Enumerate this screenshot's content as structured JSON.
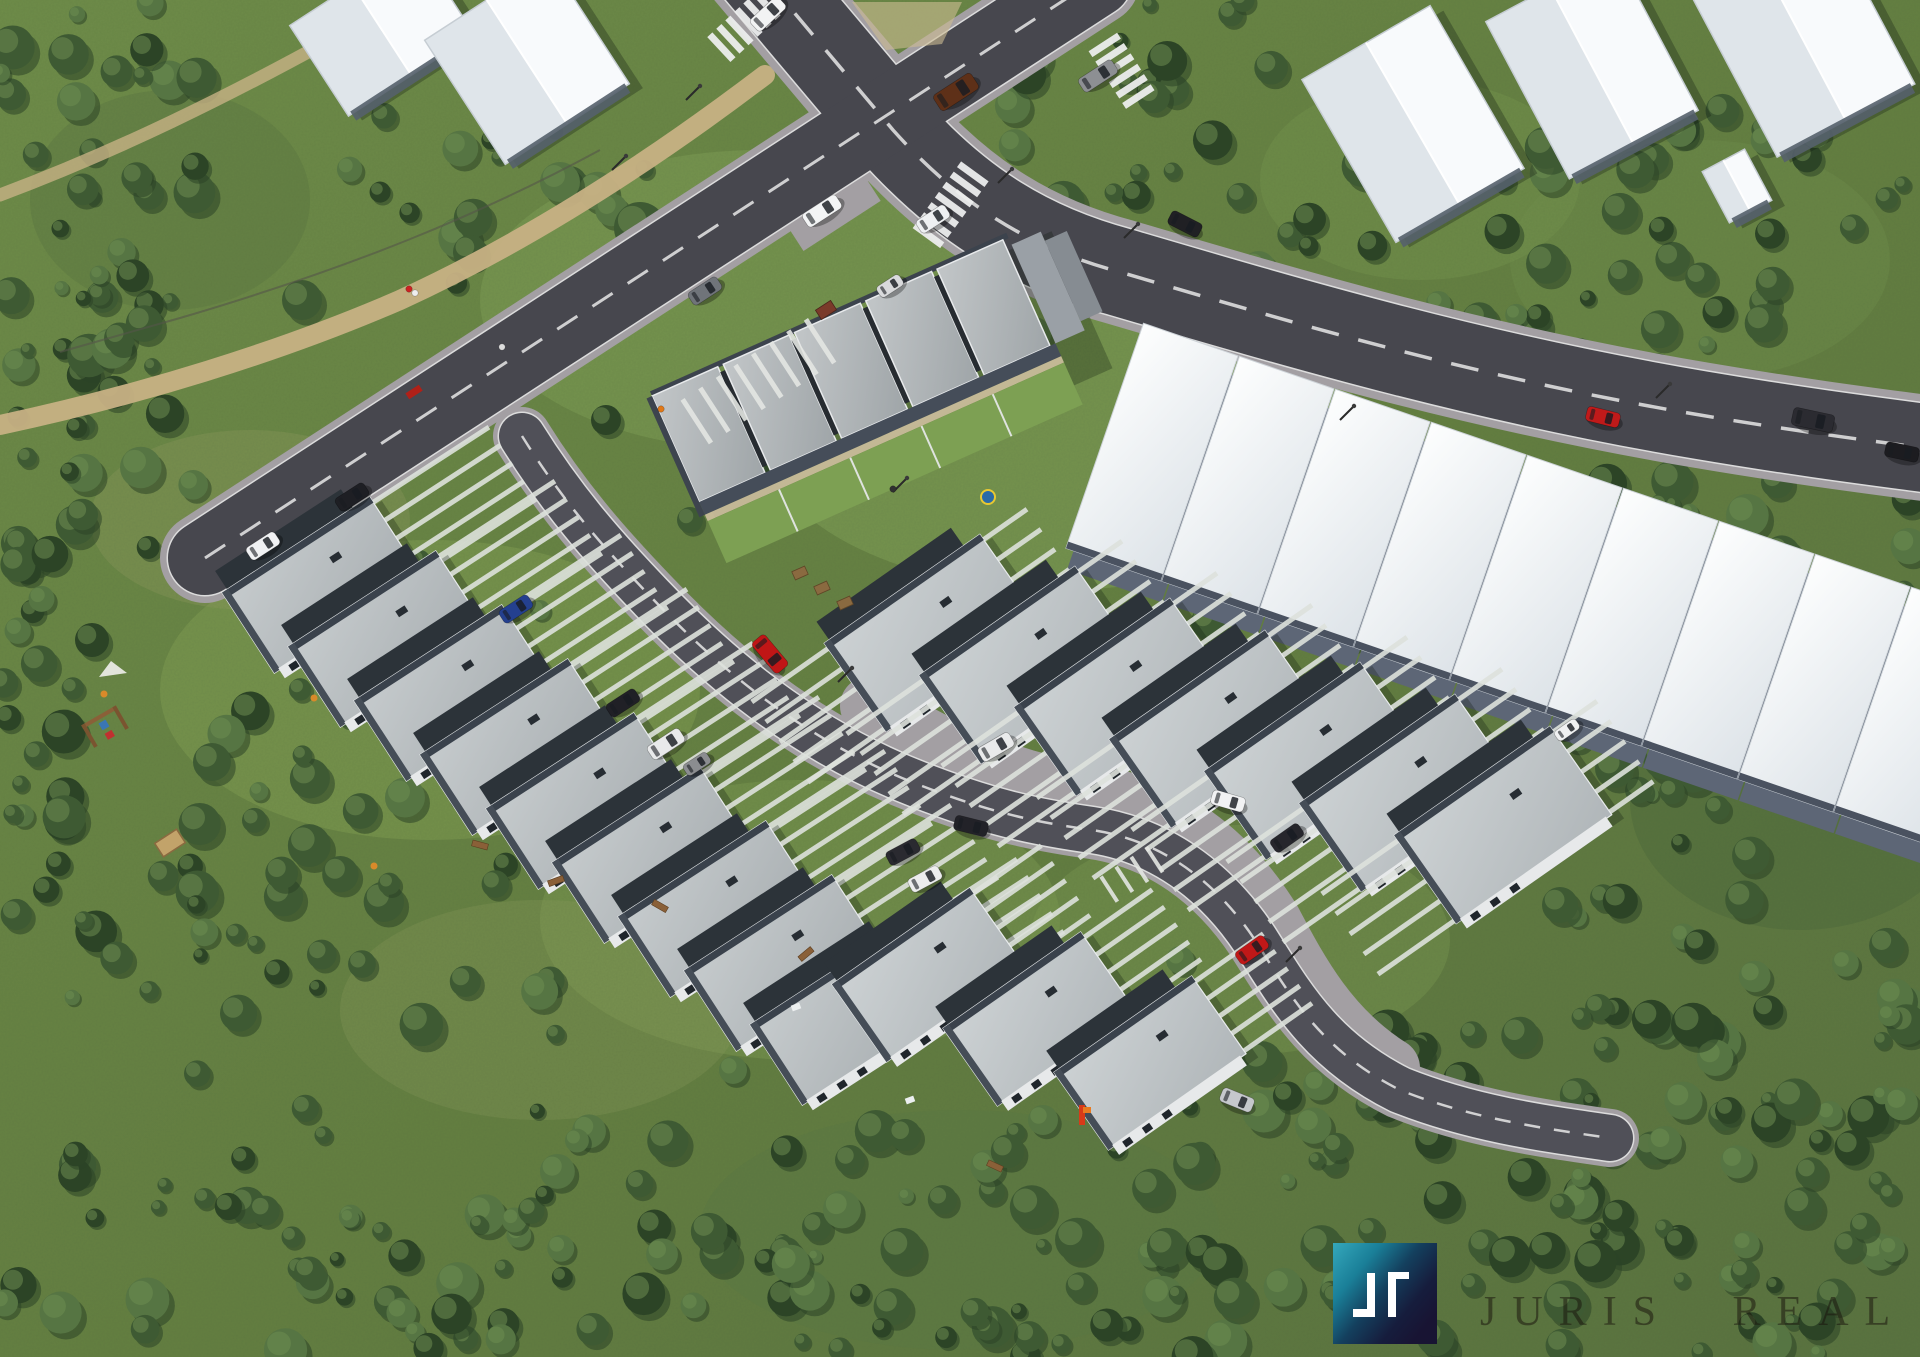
{
  "branding": {
    "watermark_text": "JURIS REAL",
    "logo": {
      "x": 1333,
      "y": 1243,
      "w": 104,
      "h": 101,
      "teal": "#35a8bc",
      "mid": "#1a7f98",
      "deep": "#14405e",
      "navy1": "#161d3d",
      "navy2": "#181433",
      "glyph_color": "#ffffff",
      "glyph_left_path": "M1367 1273 H1375 V1317 H1353 V1309 H1367 Z",
      "glyph_right_path": "M1388 1272 H1409 V1279 H1396 V1317 H1388 Z"
    }
  },
  "palette": {
    "grass1": "#6f8d49",
    "grass2": "#647f41",
    "grass3": "#5a7340",
    "forest_dark": "#2c4426",
    "forest_mid": "#3e5a33",
    "forest_light": "#567543",
    "forest_hi": "#6d8c50",
    "asphalt": "#47474e",
    "asphalt_inner": "#505058",
    "cobble": "#a39fa3",
    "lane": "#e8e8e8",
    "path_tan": "#c7b184",
    "stripe": "#dde1dc",
    "roof_a1": "#c6cbcd",
    "roof_a2": "#a8aeb1",
    "roof_b1": "#cdd2d4",
    "roof_b2": "#b0b6b9",
    "block_roof1": "#c2c6c8",
    "block_roof2": "#9fa5a8",
    "white_roof1": "#fdfefe",
    "white_roof2": "#dde3e8",
    "parapet": "#3a424c",
    "dark_band": "#2c3339",
    "facade": "#e7e9ea",
    "wall_dark": "#55606c"
  },
  "scene": {
    "terrain_patches": [
      {
        "cx": 430,
        "cy": 690,
        "rx": 270,
        "ry": 150,
        "c": "#84a155",
        "o": 0.45
      },
      {
        "cx": 800,
        "cy": 920,
        "rx": 260,
        "ry": 140,
        "c": "#82a055",
        "o": 0.4
      },
      {
        "cx": 1240,
        "cy": 940,
        "rx": 210,
        "ry": 115,
        "c": "#7d9b52",
        "o": 0.4
      },
      {
        "cx": 1060,
        "cy": 430,
        "rx": 300,
        "ry": 160,
        "c": "#83a459",
        "o": 0.5
      },
      {
        "cx": 760,
        "cy": 300,
        "rx": 280,
        "ry": 150,
        "c": "#7fa055",
        "o": 0.5
      },
      {
        "cx": 250,
        "cy": 520,
        "rx": 160,
        "ry": 90,
        "c": "#8f9a5e",
        "o": 0.35
      },
      {
        "cx": 540,
        "cy": 1010,
        "rx": 200,
        "ry": 110,
        "c": "#8c9a5c",
        "o": 0.3
      },
      {
        "cx": 1700,
        "cy": 260,
        "rx": 190,
        "ry": 120,
        "c": "#6e8c4a",
        "o": 0.5
      },
      {
        "cx": 1420,
        "cy": 180,
        "rx": 160,
        "ry": 100,
        "c": "#75944e",
        "o": 0.45
      },
      {
        "cx": 170,
        "cy": 200,
        "rx": 140,
        "ry": 110,
        "c": "#5d7a42",
        "o": 0.5
      },
      {
        "cx": 1800,
        "cy": 800,
        "rx": 170,
        "ry": 130,
        "c": "#4e6a3c",
        "o": 0.5
      },
      {
        "cx": 960,
        "cy": 1230,
        "rx": 260,
        "ry": 120,
        "c": "#5c7a44",
        "o": 0.5
      }
    ],
    "forests": [
      {
        "x": 0,
        "y": 0,
        "w": 200,
        "h": 560,
        "n": 55,
        "seed": 11
      },
      {
        "x": 0,
        "y": 540,
        "w": 120,
        "h": 240,
        "n": 16,
        "seed": 12
      },
      {
        "x": 0,
        "y": 780,
        "w": 560,
        "h": 577,
        "n": 95,
        "seed": 13
      },
      {
        "x": 530,
        "y": 1130,
        "w": 640,
        "h": 227,
        "n": 55,
        "seed": 14
      },
      {
        "x": 1150,
        "y": 1030,
        "w": 770,
        "h": 327,
        "n": 115,
        "seed": 15
      },
      {
        "x": 1545,
        "y": 470,
        "w": 375,
        "h": 580,
        "n": 85,
        "seed": 16
      },
      {
        "x": 1570,
        "y": 90,
        "w": 350,
        "h": 350,
        "n": 38,
        "seed": 17
      },
      {
        "x": 1245,
        "y": 125,
        "w": 320,
        "h": 200,
        "n": 24,
        "seed": 18
      },
      {
        "x": 985,
        "y": 0,
        "w": 290,
        "h": 210,
        "n": 26,
        "seed": 19
      },
      {
        "x": 315,
        "y": 115,
        "w": 340,
        "h": 175,
        "n": 16,
        "seed": 20
      },
      {
        "x": 205,
        "y": 600,
        "w": 220,
        "h": 200,
        "n": 8,
        "seed": 21
      }
    ],
    "trees": [
      [
        640,
        228,
        26
      ],
      [
        560,
        182,
        20
      ],
      [
        470,
        252,
        17
      ],
      [
        302,
        300,
        20
      ],
      [
        880,
        318,
        15
      ],
      [
        1034,
        334,
        17
      ],
      [
        1140,
        420,
        19
      ],
      [
        1258,
        518,
        21
      ],
      [
        1208,
        622,
        17
      ],
      [
        1416,
        624,
        15
      ],
      [
        690,
        520,
        13
      ],
      [
        606,
        420,
        15
      ],
      [
        762,
        472,
        11
      ],
      [
        1320,
        758,
        15
      ],
      [
        1462,
        800,
        13
      ],
      [
        92,
        640,
        17
      ],
      [
        212,
        762,
        19
      ],
      [
        540,
        610,
        10
      ],
      [
        420,
        560,
        10
      ],
      [
        330,
        480,
        11
      ],
      [
        1560,
        905,
        18
      ],
      [
        1180,
        960,
        14
      ],
      [
        905,
        1135,
        16
      ],
      [
        1043,
        1120,
        15
      ],
      [
        733,
        1070,
        14
      ],
      [
        850,
        1160,
        15
      ],
      [
        1350,
        640,
        12
      ],
      [
        1240,
        690,
        11
      ]
    ],
    "paths": [
      {
        "name": "footpath-main",
        "d": "M765,75 C640,170 520,245 400,300 C280,352 140,395 0,425",
        "w": 20,
        "o": 0.95
      },
      {
        "name": "footpath-corner",
        "d": "M330,40 C230,95 120,150 0,195",
        "w": 13,
        "o": 0.8
      }
    ],
    "fence": {
      "d": "M600,150 C480,215 350,268 180,318 L60,352"
    },
    "roads": [
      {
        "name": "main-road",
        "d": "M733,-60 L893,130 C960,205 1030,248 1120,272 C1300,325 1480,378 1700,415 C1800,432 1880,442 1940,450",
        "w": 88,
        "cas": 106,
        "dash": "28 20",
        "dw": 3.5
      },
      {
        "name": "cross-road",
        "d": "M205,558 L1095,-20",
        "w": 74,
        "cas": 90,
        "dash": "24 18",
        "dw": 3
      },
      {
        "name": "inner-road",
        "d": "M522,436 C562,500 602,546 650,596 C722,672 802,736 902,778 C985,812 1035,822 1092,830 C1160,840 1215,880 1255,940 C1290,995 1320,1050 1400,1090 C1470,1118 1540,1128 1610,1138",
        "w": 46,
        "cas": 58,
        "dash": "16 14",
        "dw": 2.5
      }
    ],
    "cobble_band": {
      "d": "M870,706 C950,756 1015,782 1090,794 C1180,808 1235,862 1272,922 C1300,975 1330,1030 1390,1068",
      "w": 60
    },
    "island": {
      "pts": "852,2 962,2 942,44 886,50",
      "c": "#cdbd93",
      "o": 0.6
    },
    "crosswalks": [
      {
        "x": 742,
        "y": 28,
        "rot": 47,
        "n": 6,
        "span": 74
      },
      {
        "x": 1123,
        "y": 73,
        "rot": -33,
        "n": 6,
        "span": 74
      },
      {
        "x": 949,
        "y": 207,
        "rot": 36,
        "n": 7,
        "span": 88
      }
    ],
    "laybys": [
      {
        "x": 835,
        "y": 215,
        "rot": -33,
        "w": 92,
        "h": 26
      },
      {
        "x": 243,
        "y": 547,
        "rot": -33,
        "w": 72,
        "h": 24
      }
    ],
    "neighbors": [
      {
        "x": 382,
        "y": 30,
        "rot": -33,
        "w": 150,
        "h": 108
      },
      {
        "x": 527,
        "y": 62,
        "rot": -33,
        "w": 148,
        "h": 148
      },
      {
        "x": 1413,
        "y": 124,
        "rot": -30,
        "w": 148,
        "h": 188
      },
      {
        "x": 1592,
        "y": 66,
        "rot": -28,
        "w": 146,
        "h": 178
      },
      {
        "x": 1800,
        "y": 34,
        "rot": -28,
        "w": 156,
        "h": 196
      },
      {
        "x": 1737,
        "y": 186,
        "rot": -28,
        "w": 48,
        "h": 58
      }
    ],
    "central_block": {
      "x": 652,
      "y": 396,
      "rot": -24,
      "units": 5,
      "uw": 78,
      "rw": 72,
      "depth": 116
    },
    "long_white": {
      "x0": 1152,
      "y0": 452,
      "dx": 96,
      "dy": 33,
      "rot": 19,
      "count": 9,
      "w": 100,
      "h": 238
    },
    "house_groups": [
      {
        "name": "west-cascade",
        "count": 9,
        "cx": 322,
        "cy": 585,
        "dx": 66,
        "dy": 54,
        "rot": -33,
        "w": 176,
        "h": 96,
        "roof": "a",
        "sne": 140,
        "ssw": 0
      },
      {
        "name": "east-row",
        "count": 7,
        "cx": 933,
        "cy": 633,
        "dx": 95,
        "dy": 32,
        "rot": -35,
        "w": 190,
        "h": 108,
        "roof": "b",
        "sne": 55,
        "ssw": 95
      },
      {
        "name": "south-row",
        "count": 3,
        "cx": 928,
        "cy": 975,
        "dx": 111,
        "dy": 44,
        "rot": -35,
        "w": 168,
        "h": 95,
        "roof": "b",
        "sne": 85,
        "ssw": 0
      }
    ],
    "stripe_groups": [
      {
        "x": 808,
        "y": 318,
        "rot": 57,
        "count": 8,
        "gap": 21,
        "len": 52,
        "wid": 5
      },
      {
        "x": 1148,
        "y": 846,
        "rot": 57,
        "count": 4,
        "gap": 18,
        "len": 30,
        "wid": 4
      }
    ],
    "cars": [
      {
        "x": 263,
        "y": 546,
        "r": -33,
        "c": "#f0f1f3"
      },
      {
        "x": 352,
        "y": 497,
        "r": -33,
        "c": "#1e1f24"
      },
      {
        "x": 705,
        "y": 291,
        "r": -33,
        "c": "#70747a"
      },
      {
        "x": 822,
        "y": 211,
        "r": -33,
        "c": "#f3f4f5",
        "l": 40,
        "w": 16
      },
      {
        "x": 933,
        "y": 219,
        "r": -33,
        "c": "#eef0f2"
      },
      {
        "x": 890,
        "y": 286,
        "r": -33,
        "c": "#d9dadc",
        "l": 27,
        "w": 13
      },
      {
        "x": 956,
        "y": 92,
        "r": -33,
        "c": "#5e3018",
        "l": 45,
        "w": 19
      },
      {
        "x": 1098,
        "y": 76,
        "r": -33,
        "c": "#8d8f93",
        "l": 40,
        "w": 16
      },
      {
        "x": 768,
        "y": 14,
        "r": -43,
        "c": "#f2f3f4",
        "l": 38,
        "w": 16
      },
      {
        "x": 1185,
        "y": 224,
        "r": 27,
        "c": "#202024"
      },
      {
        "x": 1603,
        "y": 417,
        "r": 14,
        "c": "#c01a1a"
      },
      {
        "x": 1813,
        "y": 420,
        "r": 12,
        "c": "#2b2b31",
        "l": 42,
        "w": 18
      },
      {
        "x": 1902,
        "y": 452,
        "r": 12,
        "c": "#1c1c20"
      },
      {
        "x": 770,
        "y": 654,
        "r": 50,
        "c": "#c01616",
        "l": 40,
        "w": 17
      },
      {
        "x": 971,
        "y": 826,
        "r": 14,
        "c": "#222228"
      },
      {
        "x": 1228,
        "y": 801,
        "r": 16,
        "c": "#f1f2f3"
      },
      {
        "x": 516,
        "y": 609,
        "r": -33,
        "c": "#24408f"
      },
      {
        "x": 623,
        "y": 703,
        "r": -33,
        "c": "#202026"
      },
      {
        "x": 666,
        "y": 744,
        "r": -33,
        "c": "#e8e9ea",
        "l": 38,
        "w": 16
      },
      {
        "x": 903,
        "y": 852,
        "r": -28,
        "c": "#2a2a30"
      },
      {
        "x": 925,
        "y": 879,
        "r": -28,
        "c": "#eceded"
      },
      {
        "x": 996,
        "y": 747,
        "r": -30,
        "c": "#e9eaeb",
        "l": 36,
        "w": 16
      },
      {
        "x": 1237,
        "y": 1100,
        "r": 22,
        "c": "#c6c8cc"
      },
      {
        "x": 1287,
        "y": 838,
        "r": -35,
        "c": "#26262c"
      },
      {
        "x": 1567,
        "y": 730,
        "r": -35,
        "c": "#f0f1f2",
        "l": 26,
        "w": 12
      },
      {
        "x": 1252,
        "y": 950,
        "r": -35,
        "c": "#c01818"
      },
      {
        "x": 697,
        "y": 764,
        "r": -33,
        "c": "#8b8d90",
        "l": 28,
        "w": 13
      }
    ],
    "lamps": [
      [
        612,
        170
      ],
      [
        686,
        100
      ],
      [
        998,
        183
      ],
      [
        1124,
        238
      ],
      [
        893,
        492
      ],
      [
        838,
        682
      ],
      [
        1340,
        420
      ],
      [
        1656,
        398
      ],
      [
        1286,
        962
      ]
    ],
    "people": [
      {
        "x": 409,
        "y": 289,
        "c": "#cc2222"
      },
      {
        "x": 415,
        "y": 293,
        "c": "#eeeeee"
      },
      {
        "x": 502,
        "y": 347,
        "c": "#dddddd"
      },
      {
        "x": 661,
        "y": 409,
        "c": "#e07818"
      },
      {
        "x": 893,
        "y": 489,
        "c": "#303030"
      }
    ],
    "props": {
      "tables": [
        [
          800,
          573
        ],
        [
          822,
          588
        ],
        [
          845,
          603
        ]
      ],
      "bench": {
        "x": 414,
        "y": 392,
        "c": "#b02018"
      },
      "dumpster": {
        "x": 826,
        "y": 310,
        "c": "#7a3a2a"
      },
      "pool": {
        "x": 988,
        "y": 497,
        "c": "#2a6aa8",
        "ring": "#e8c832"
      },
      "balls": [
        [
          104,
          694
        ],
        [
          314,
          698
        ],
        [
          374,
          866
        ]
      ],
      "wood": [
        [
          480,
          845,
          15
        ],
        [
          556,
          881,
          -20
        ],
        [
          660,
          906,
          30
        ],
        [
          806,
          954,
          -40
        ],
        [
          995,
          1166,
          25
        ]
      ],
      "paper": [
        [
          910,
          1100
        ],
        [
          796,
          1007
        ]
      ],
      "frame": {
        "x": 100,
        "y": 718
      },
      "sail": {
        "x": 113,
        "y": 671
      },
      "sandbox": {
        "x": 170,
        "y": 843
      },
      "toy": {
        "x": 1082,
        "y": 1115
      }
    }
  }
}
